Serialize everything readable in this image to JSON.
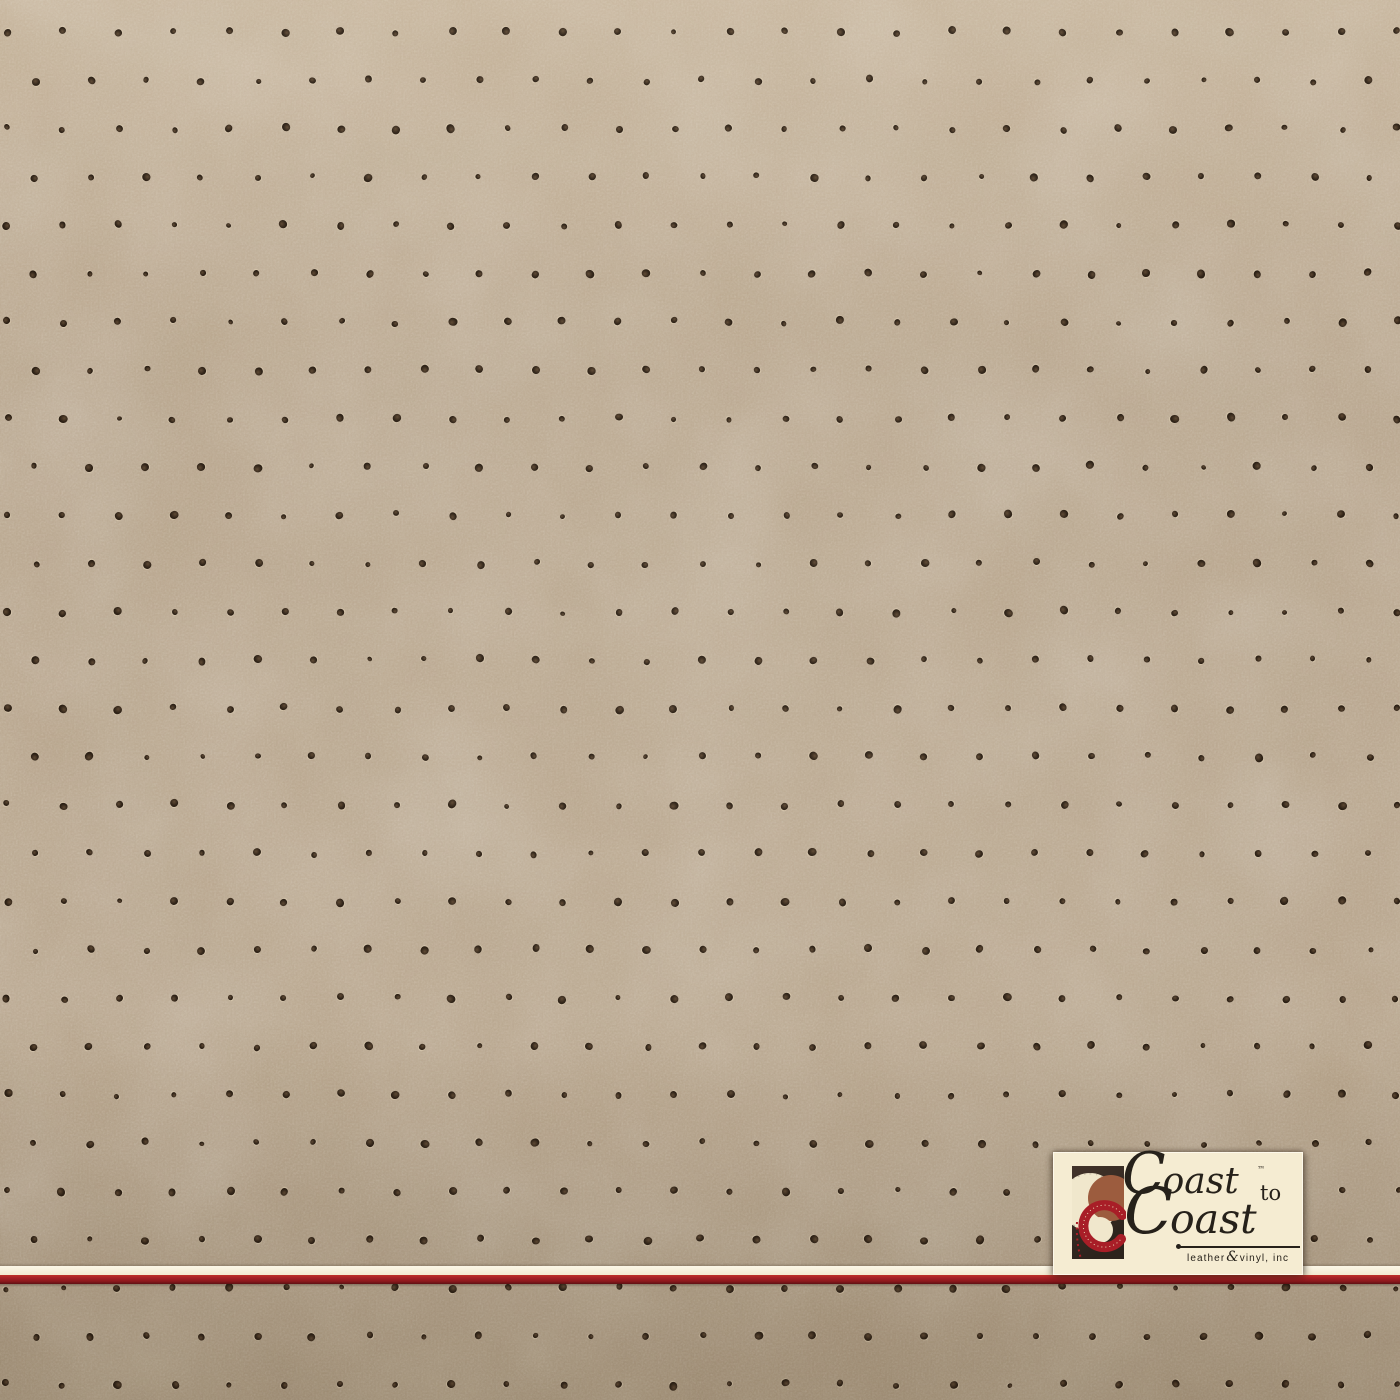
{
  "page": {
    "description": "Perforated beige leather and vinyl upholstery material sample swatch with Coast to Coast brand badge"
  },
  "colors": {
    "leather_base": "#b5a289",
    "leather_light": "#c1ae94",
    "leather_dark": "#a28f75",
    "dot_outer": "#281c11",
    "dot_core": "#5a4530",
    "stripe_cream": "#f2e9cf",
    "stripe_highlight": "#fcf7e7",
    "stripe_red": "#a32025",
    "stripe_red_deep": "#5f1113",
    "logo_bg": "#f5ecd2",
    "logo_border": "#fdf8ea",
    "logo_text": "#26211a",
    "mark_rect": "#42332a",
    "mark_rect_dark": "#2c231c",
    "mark_cream": "#f0e7cc",
    "mark_brown": "#9c5c3e",
    "mark_red": "#a81e27",
    "mark_stitch": "#ead9b6"
  },
  "perforation": {
    "origin_x": 7,
    "origin_y": 32,
    "spacing_x": 55.6,
    "spacing_y": 48.3,
    "row_offset": 27.8,
    "dot_size": 6.6,
    "jitter": 1.6,
    "seed": 11,
    "canvas_w": 1400,
    "canvas_h": 1400
  },
  "logo": {
    "brand_line1_initial": "C",
    "brand_line1_rest": "oast",
    "trademark": "™",
    "connector": "to",
    "brand_line2_initial": "C",
    "brand_line2_rest": "oast",
    "tagline_leather": "leather",
    "tagline_ampersand": "&",
    "tagline_suffix": "vinyl, inc"
  }
}
